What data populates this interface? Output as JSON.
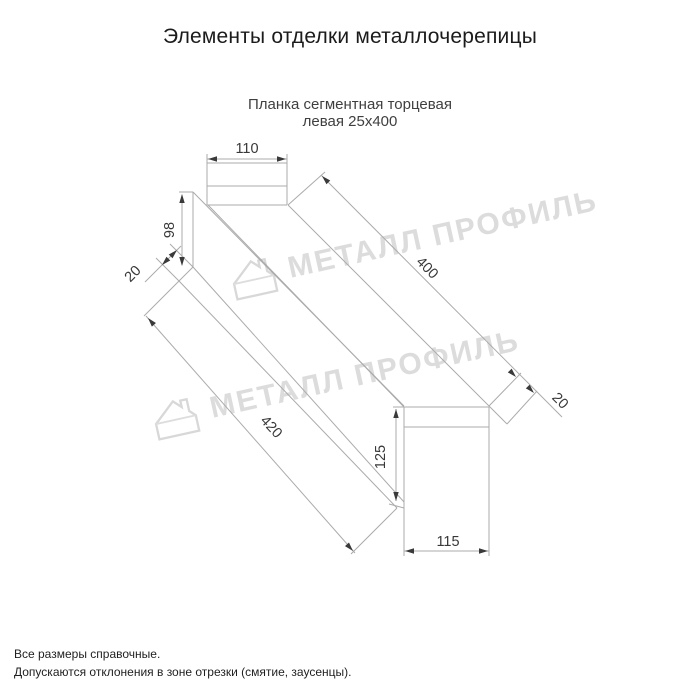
{
  "page": {
    "title": "Элементы отделки металлочерепицы",
    "subtitle_line1": "Планка сегментная торцевая",
    "subtitle_line2": "левая 25х400"
  },
  "drawing": {
    "dims": {
      "top_width": "110",
      "left_height": "98",
      "left_flange": "20",
      "top_length": "400",
      "right_flange": "20",
      "bottom_length": "420",
      "right_height": "125",
      "bottom_width": "115"
    }
  },
  "watermark": {
    "text": "МЕТАЛЛ ПРОФИЛЬ",
    "color": "#d6d6d6"
  },
  "footer": {
    "line1": "Все размеры справочные.",
    "line2": "Допускаются отклонения в зоне отрезки (смятие, заусенцы)."
  },
  "colors": {
    "background": "#ffffff",
    "drawing_lines": "#ababab",
    "dimension_text": "#383838",
    "title_text": "#1b1b1b",
    "subtitle_text": "#3f3f3f"
  }
}
